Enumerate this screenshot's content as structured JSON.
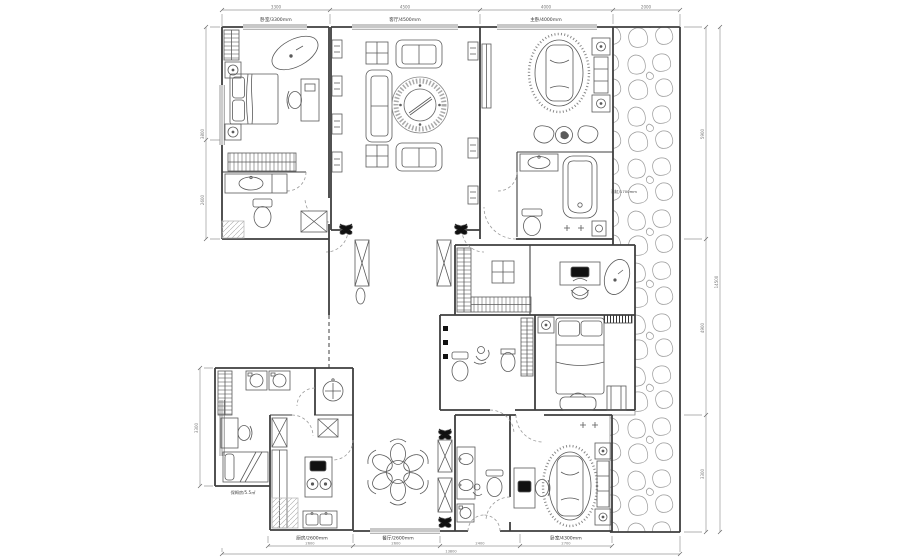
{
  "palette": {
    "wall": "#3f3f3f",
    "furniture_line": "#5a5a5a",
    "thin_line": "#8c8c8c",
    "dark_fill": "#111111",
    "label_dark": "#333333",
    "label_light": "#777777",
    "background": "#ffffff"
  },
  "labels": {
    "top_dims": [
      "3300",
      "4500",
      "4000",
      "2000"
    ],
    "top_rooms": [
      "卧室/3300mm",
      "客厅/4500mm",
      "主卧/4000mm"
    ],
    "left_dims": [
      "3800",
      "2600",
      "3300"
    ],
    "right_dims": [
      "5900",
      "4900",
      "3300"
    ],
    "right_total": "14500",
    "bottom_rooms": [
      "厨房/2600mm",
      "餐厅/2600mm",
      "卧室/4300mm"
    ],
    "bottom_dims": [
      "2600",
      "2600",
      "2400",
      "2700"
    ],
    "bottom_total": "13800",
    "bath_label": "浴缸/1700mm",
    "maid_label": "保姆房/5.5㎡"
  }
}
